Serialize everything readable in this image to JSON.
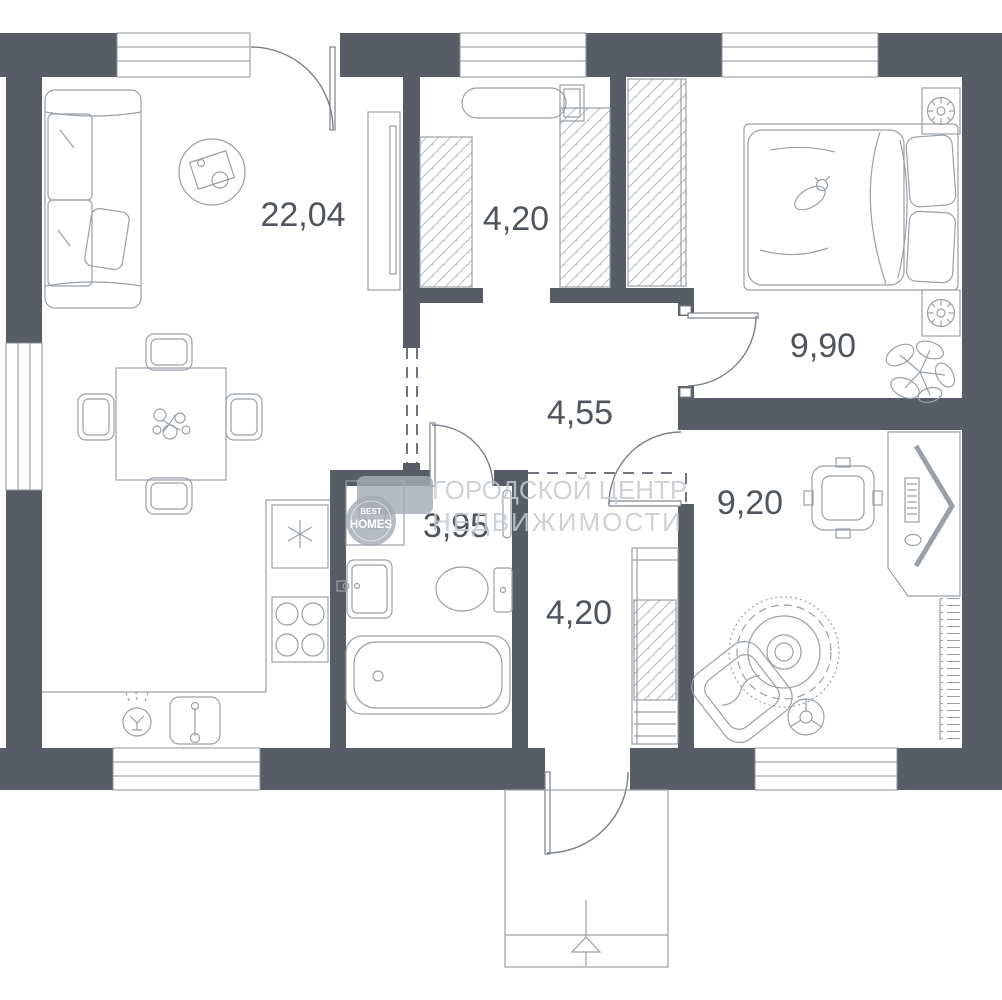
{
  "plan": {
    "title": "apartment floor plan",
    "watermark": {
      "line1": "ГОРОДСКОЙ ЦЕНТР",
      "line2": "НЕДВИЖИМОСТИ"
    },
    "logo": {
      "top": "BEST",
      "bottom": "HOMES"
    },
    "rooms": [
      {
        "id": "living-kitchen",
        "area": "22,04"
      },
      {
        "id": "dressing-room",
        "area": "4,20"
      },
      {
        "id": "bedroom",
        "area": "9,90"
      },
      {
        "id": "hallway",
        "area": "4,55"
      },
      {
        "id": "bathroom",
        "area": "3,95"
      },
      {
        "id": "entry-hall",
        "area": "4,20"
      },
      {
        "id": "kids-room",
        "area": "9,20"
      }
    ],
    "colors": {
      "wall": "#575c66",
      "furniture": "#9aa0a8",
      "label": "#4f545d",
      "watermark": "#c6cad0",
      "background": "#ffffff"
    }
  }
}
